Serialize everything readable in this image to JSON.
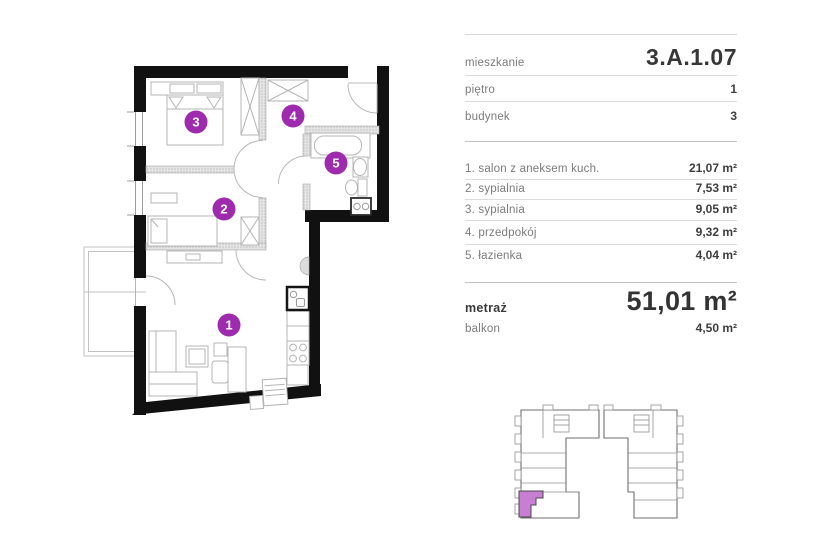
{
  "colors": {
    "accent": "#9e2bad",
    "highlight": "#c87fd3",
    "wall": "#111111"
  },
  "panel": {
    "info_rows": [
      {
        "label": "mieszkanie",
        "value": "3.A.1.07"
      },
      {
        "label": "piętro",
        "value": "1"
      },
      {
        "label": "budynek",
        "value": "3"
      }
    ],
    "room_rows": [
      {
        "label": "1. salon z aneksem kuch.",
        "value": "21,07 m²"
      },
      {
        "label": "2. sypialnia",
        "value": "7,53 m²"
      },
      {
        "label": "3. sypialnia",
        "value": "9,05 m²"
      },
      {
        "label": "4. przedpokój",
        "value": "9,32 m²"
      },
      {
        "label": "5. łazienka",
        "value": "4,04 m²"
      }
    ],
    "summary": {
      "area_label": "metraż",
      "area_value": "51,01 m²",
      "balcony_label": "balkon",
      "balcony_value": "4,50 m²"
    }
  },
  "plan": {
    "markers": [
      {
        "num": "1"
      },
      {
        "num": "2"
      },
      {
        "num": "3"
      },
      {
        "num": "4"
      },
      {
        "num": "5"
      }
    ]
  }
}
